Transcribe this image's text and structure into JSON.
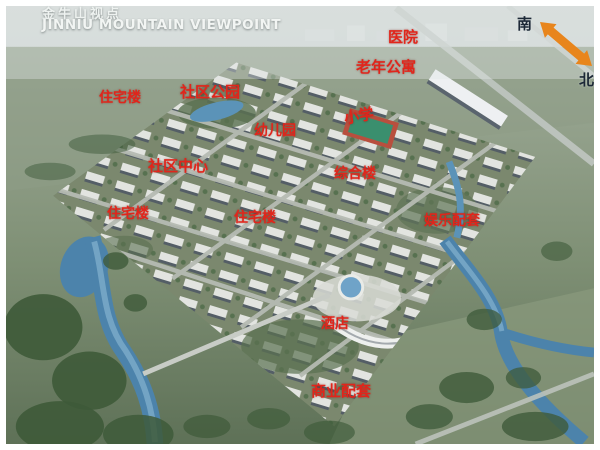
{
  "header": {
    "title_zh": "金牛山视点",
    "title_en": "JINNIU MOUNTAIN VIEWPOINT"
  },
  "compass": {
    "south_label": "南",
    "north_label": "北"
  },
  "labels": [
    {
      "id": "hospital",
      "text": "医院"
    },
    {
      "id": "senior-apartments",
      "text": "老年公寓"
    },
    {
      "id": "residential-1",
      "text": "住宅楼"
    },
    {
      "id": "community-park",
      "text": "社区公园"
    },
    {
      "id": "kindergarten",
      "text": "幼儿园"
    },
    {
      "id": "primary-school",
      "text": "小学"
    },
    {
      "id": "community-center",
      "text": "社区中心"
    },
    {
      "id": "complex-building",
      "text": "综合楼"
    },
    {
      "id": "residential-2",
      "text": "住宅楼"
    },
    {
      "id": "residential-3",
      "text": "住宅楼"
    },
    {
      "id": "entertainment-amenities",
      "text": "娱乐配套"
    },
    {
      "id": "hotel",
      "text": "酒店"
    },
    {
      "id": "commercial-amenities",
      "text": "商业配套"
    }
  ],
  "colors": {
    "annotation_red": "#e1251b",
    "title_white": "#f2f5f3",
    "compass_arrow_orange": "#e8851c",
    "compass_text_dark": "#1c2836",
    "river_blue": "#4c83ab",
    "tree_green": "#3e5a39"
  }
}
